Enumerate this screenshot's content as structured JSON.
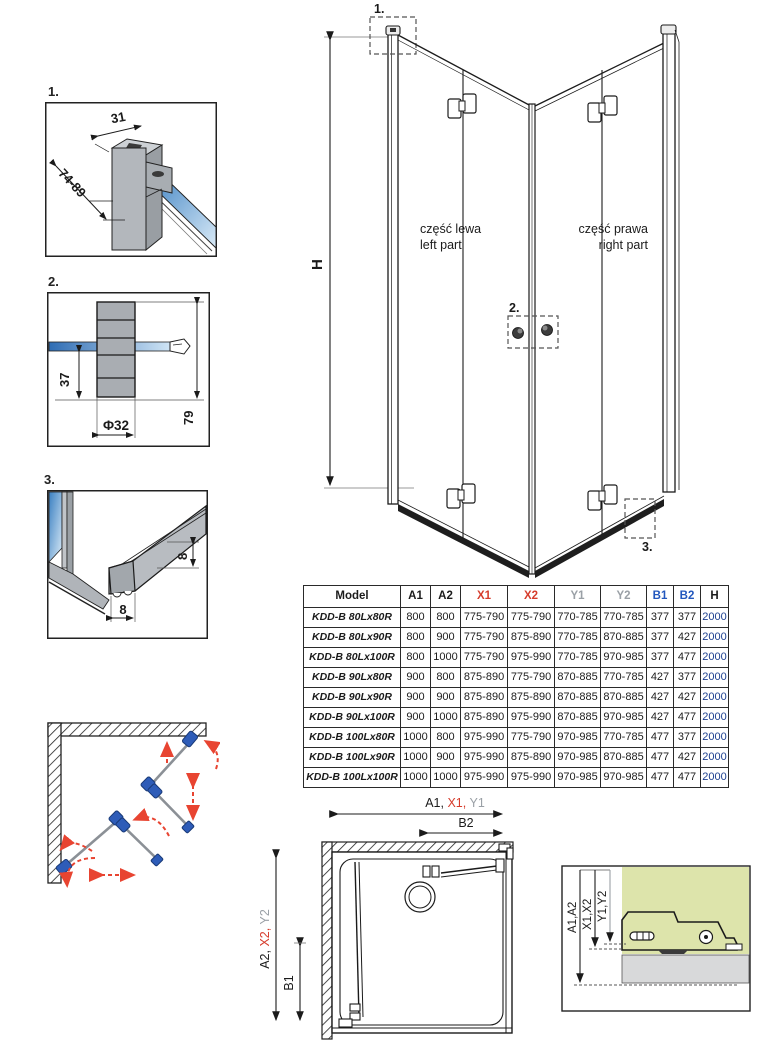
{
  "colors": {
    "red": "#d63c2c",
    "blue": "#2257be",
    "gray": "#9aa0a6",
    "green_bg": "#dde4ab",
    "glass_blue": "#3a7fc1",
    "hinge_blue": "#2e5cb8",
    "arrow_red": "#e84431"
  },
  "details": {
    "d1": {
      "label": "1.",
      "dim_top": "31",
      "dim_side": "74-89"
    },
    "d2": {
      "label": "2.",
      "dim_offset": "37",
      "dim_diameter": "Φ32",
      "dim_height": "79"
    },
    "d3": {
      "label": "3.",
      "dim_width": "8",
      "dim_height": "8"
    }
  },
  "main": {
    "dim_height": "H",
    "marker1": "1.",
    "marker2": "2.",
    "marker3": "3.",
    "left_part_pl": "część lewa",
    "left_part_en": "left part",
    "right_part_pl": "część prawa",
    "right_part_en": "right part"
  },
  "table": {
    "headers": [
      "Model",
      "A1",
      "A2",
      "X1",
      "X2",
      "Y1",
      "Y2",
      "B1",
      "B2",
      "H"
    ],
    "rows": [
      {
        "model": "KDD-B 80Lx80R",
        "values": [
          "800",
          "800",
          "775-790",
          "775-790",
          "770-785",
          "770-785",
          "377",
          "377",
          "2000"
        ]
      },
      {
        "model": "KDD-B 80Lx90R",
        "values": [
          "800",
          "900",
          "775-790",
          "875-890",
          "770-785",
          "870-885",
          "377",
          "427",
          "2000"
        ]
      },
      {
        "model": "KDD-B 80Lx100R",
        "values": [
          "800",
          "1000",
          "775-790",
          "975-990",
          "770-785",
          "970-985",
          "377",
          "477",
          "2000"
        ]
      },
      {
        "model": "KDD-B 90Lx80R",
        "values": [
          "900",
          "800",
          "875-890",
          "775-790",
          "870-885",
          "770-785",
          "427",
          "377",
          "2000"
        ]
      },
      {
        "model": "KDD-B 90Lx90R",
        "values": [
          "900",
          "900",
          "875-890",
          "875-890",
          "870-885",
          "870-885",
          "427",
          "427",
          "2000"
        ]
      },
      {
        "model": "KDD-B 90Lx100R",
        "values": [
          "900",
          "1000",
          "875-890",
          "975-990",
          "870-885",
          "970-985",
          "427",
          "477",
          "2000"
        ]
      },
      {
        "model": "KDD-B 100Lx80R",
        "values": [
          "1000",
          "800",
          "975-990",
          "775-790",
          "970-985",
          "770-785",
          "477",
          "377",
          "2000"
        ]
      },
      {
        "model": "KDD-B 100Lx90R",
        "values": [
          "1000",
          "900",
          "975-990",
          "875-890",
          "970-985",
          "870-885",
          "477",
          "427",
          "2000"
        ]
      },
      {
        "model": "KDD-B 100Lx100R",
        "values": [
          "1000",
          "1000",
          "975-990",
          "975-990",
          "970-985",
          "970-985",
          "477",
          "477",
          "2000"
        ]
      }
    ]
  },
  "plan": {
    "top_a1": "A1, ",
    "top_x1": "X1, ",
    "top_y1": "Y1",
    "b2": "B2",
    "left_a2": "A2, ",
    "left_x2": "X2, ",
    "left_y2": "Y2",
    "b1": "B1"
  },
  "section": {
    "a": "A1,A2",
    "x": "X1,X2",
    "y": "Y1,Y2"
  }
}
